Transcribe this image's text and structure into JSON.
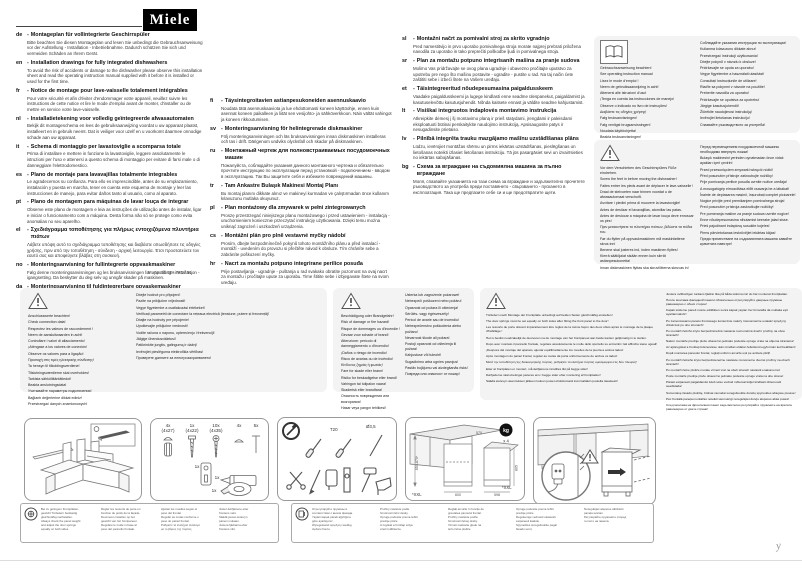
{
  "brand": {
    "logo": "Miele"
  },
  "doc_number": "M.-Nr. 10 006 780 / 01",
  "languages": {
    "col1": [
      {
        "code": "de",
        "title": "Montageplan für vollintegrierte Geschirrspüler",
        "body": "Bitte beachten Sie diesen Montageplan und lesen Sie unbedingt die Gebrauchsanweisung vor der Aufstellung - Installation - Inbetriebnahme. Dadurch schützen Sie sich und vermeiden Schäden an Ihrem Gerät."
      },
      {
        "code": "en",
        "title": "Installation drawings for fully integrated dishwashers",
        "body": "To avoid the risk of accidents or damage to the dishwasher please observe this installation sheet and read the operating instruction manual supplied with it before it is installed or used for the first time."
      },
      {
        "code": "fr",
        "title": "Notice de montage pour lave-vaisselle totalement intégrables",
        "body": "Pour votre sécurité et afin d'éviter d'endommager votre appareil, veuillez suivre les instructions de cette notice et lire le mode d'emploi avant de monter, d'installer ou de mettre en service votre lave-vaisselle."
      },
      {
        "code": "nl",
        "title": "Installatietekening voor volledig geïntegreerde afwasautomaten",
        "body": "Bekijk dit montageschema en lees de gebruiksaanwijzing voordat u uw apparaat plaatst, installeert en in gebruik neemt. Dat is veiliger voor uzelf en u voorkomt daarmee onnodige schade aan uw apparaat."
      },
      {
        "code": "it",
        "title": "Schema di montaggio per lavastoviglie a scomparsa totale",
        "body": "Prima di installare e mettere in funzione la lavastoviglie, leggere assolutamente le istruzioni per l'uso e attenersi a questo schema di montaggio per evitare di farsi male o di danneggiare l'elettrodomestico."
      },
      {
        "code": "es",
        "title": "Plano de montaje para lavavajillas totalmente integrables",
        "body": "Le agradecemos su confianza. Para ello es imprescindible, antes de su emplazamiento, instalación y puesta en marcha, tener en cuenta este esquema de montaje y leer las instrucciones de manejo, para evitar daños tanto al usuario, como al aparato."
      },
      {
        "code": "pt",
        "title": "Plano de montagem para máquinas de lavar louça de integrar",
        "body": "Observe este plano de montagem e leia as instruções de utilização antes de instalar, ligar e iniciar o funcionamento com a máquina. Desta forma não só se protege como evita anomalias no seu aparelho."
      },
      {
        "code": "el",
        "title": "Σχεδιάγραμμα τοποθέτησης για πλήρως εντοιχιζόμενα πλυντήρια πιάτων",
        "body": "Λάβετε υπόψη αυτό το σχεδιάγραμμα τοποθέτησης και διαβάστε οπωσδήποτε τις οδηγίες χρήσης, πριν από την τοποθέτηση - σύνδεση - αρχική λειτουργία. Έτσι προστατεύετε τον εαυτό σας και αποφεύγετε βλάβες στη συσκευή."
      },
      {
        "code": "no",
        "title": "Monteringsanvisning for fullintegrerte oppvaskmaskiner",
        "body": "Følg denne monteringsanvisningen og les bruksanvisningen før oppstilling - installasjon - igangsetting. Da beskytter du deg selv og unngår skader på maskinen."
      },
      {
        "code": "da",
        "title": "Monteringsanvisning til fuldintegrerbare opvaskemaskiner",
        "body": "Følg venligst denne monteringsplan, og læs brugsanvisningen inden opstilling, installation og ibrugtagning for at undgå skader på personer og produkt."
      }
    ],
    "col2": [
      {
        "code": "fi",
        "title": "Täysintegroitavien astianpesukoneiden asennuskaavio",
        "body": "Noudata tätä asennuskaaviota ja lue ehdottomasti koneen käyttöohje, ennen kuin asennat koneen paikalleen ja liität sen vesijohto- ja sähköverkkoon. Näin vältät vahingot ja koneen rikkoutumisen."
      },
      {
        "code": "sv",
        "title": "Monteringsanvisning för helintegrerade diskmaskiner",
        "body": "Följ monteringsanvisningen och läs bruksanvisningen innan diskmaskinen installeras och tas i drift. Därigenom undviks olycksfall och skador på diskmaskinen."
      },
      {
        "code": "ru",
        "title": "Монтажный чертеж для полновстраиваемых посудомоечных машин",
        "body": "Пожалуйста, соблюдайте указания данного монтажного чертежа и обязательно прочтите инструкцию по эксплуатации перед установкой - подключением - вводом в эксплуатацию. Так Вы защитите себя и избежите повреждений машины."
      },
      {
        "code": "tr",
        "title": "Tam Ankastre Bulaşık Makinesi Montaj Planı",
        "body": "Bu montaj planını dikkate alınız ve makineyi kurmadan ve çalıştırmadan önce kullanım kılavuzunu mutlaka okuyunuz."
      },
      {
        "code": "pl",
        "title": "Plan montażowy dla zmywarek w pełni zintegrowanych",
        "body": "Proszę przestrzegać niniejszego planu montażowego i przed ustawieniem - instalacją - uruchomieniem koniecznie przeczytać instrukcję użytkowania. Dzięki temu można uniknąć zagrożeń i uszkodzeń urządzenia."
      },
      {
        "code": "cs",
        "title": "Montážní plán pro plně vestavné myčky nádobí",
        "body": "Prosím, dbejte bezpodmínečně pokynů tohoto montážního plánu a před instalací - montáží - uvedením do provozu si přečtěte návod k obsluze. Tím chráníte sebe a zabráníte poškození myčky."
      },
      {
        "code": "hr",
        "title": "Nacrt za montažu potpuno integrirane perilice posuđa",
        "body": "Prije postavljanja - ugradnje - puštanja u rad svakako obratite pozornost na ovaj nacrt za montažu i pročitajte upute za uporabu. Time štitite sebe i izbjegavate štete na svom uređaju."
      }
    ],
    "col3": [
      {
        "code": "sl",
        "title": "Montažni načrt za pomivalni stroj za skrito vgradnjo",
        "body": "Pred namestitvijo in prvo uporabo pomivalnega stroja morate najprej prebrati priložena navodila za uporabo in tako preprečiti poškodbe ljudi in pomivalnega stroja."
      },
      {
        "code": "sr",
        "title": "Plan za montažu potpuno integrisanih mašina za pranje sudova",
        "body": "Molimo Vas pridržavajte se ovog plana ugradnje i obavezno pročitajte uputstvo za upotrebu pre nego što mašinu postavite - ugradite - pustite u rad. Na taj način ćete zaštititi sebe i izbeći štete na Vašem uređaju."
      },
      {
        "code": "et",
        "title": "Täisintegreeritud nõudepesumasina paigaldusskeem",
        "body": "Vaadake paigaldusskeemi ja lugege kindlasti enne seadme ülespanekut, paigaldamist ja kasutuselevõttu kasutusjuhendit. Nõnda kaitsete ennast ja väldite seadme kahjustamist."
      },
      {
        "code": "lt",
        "title": "Visiškai integruotos indaplovės montavimo instrukcija",
        "body": "Atkreipkite dėmesį į šį montavimo planą ir prieš statydami, įrengdami ir paleisdami eksploatuoti būtinai perskaitykite naudojimo instrukciją. Apsisaugosite patys ir nesugadinsite prietaiso."
      },
      {
        "code": "lv",
        "title": "Pilnībā integrēta trauku mazgājamo mašīnu uzstādīšanas plāns",
        "body": "Lūdzu, ievērojiet montāžas shēmu un pirms iekārtas uzstādīšanas, pieslēgšanas un lietošanas noteikti izlasiet lietošanas instrukciju. Tā jūs pasargāsiet sevi un izvairīsieties no iekārtas sabojāšanas."
      },
      {
        "code": "bg",
        "title": "Схема за вграждане на съдомиялна машина за пълно вграждане",
        "body": "Моля, спазвайте указанията на тази схема за вграждане и задължително прочетете ръководството за употреба преди поставянето - свързването - пускането в експлоатация. Така ще предпазите себе си и ще предотвратите щети."
      }
    ]
  },
  "manual_note": {
    "left": [
      "Gebrauchsanweisung beachten!",
      "See operating instruction manual",
      "Lisez le mode d'emploi !",
      "Neem de gebruiksaanwijzing in acht!",
      "Attenersi alle istruzioni d'uso!",
      "¡Tenga en cuenta las instrucciones de manejo!",
      "Observe o indicado no livro de instruções!",
      "Διαβάστε τις οδηγίες χρήσης!",
      "Følg bruksanvisningen!",
      "Følg venligst brugsanvisningen!",
      "Noudata käyttöohjetta!",
      "Beakta bruksanvisningen!"
    ],
    "right": [
      "Соблюдайте указания инструкции по эксплуатации!",
      "Kullanma kılavuzunu dikkate alınız!",
      "Przestrzegać instrukcji użytkowania!",
      "Dbejte pokynů v návodu k obsluze!",
      "Pridržavajte se uputa za uporabu!",
      "Vegye figyelembe a használati utasítást!",
      "Consultați Instrucțiunile de utilizare!",
      "Riaďte sa pokynmi v návode na použitie!",
      "Preberite navodila za uporabo!",
      "Pridržavajte se uputstva za upotrebu!",
      "Järgige kasutusjuhendit!",
      "Žiūrėkite naudojimosi instrukciją!",
      "Ievērojiet lietošanas instrukciju!",
      "Спазвайте ръководството за употреба!"
    ]
  },
  "feet_note": {
    "left": [
      "Vor dem Verschieben des Geschirrspülers Füße eindrehen.",
      "Screw the feet in before moving the dishwasher!",
      "Faites entrer les pieds avant de déplacer le lave-vaisselle !",
      "Draai de stelvoeten naar binnen voordat u de afwasautomaat verschuift.",
      "Avvitare i piedini prima di muovere la lavastoviglie!",
      "Antes de deslizar el lavavajillas, atornillar las patas.",
      "Antes de deslocar a máquina de lavar louça deve enroscar os pés!",
      "Πριν μετακινήσετε το πλυντήριο πιάτων, βιδώστε τα πόδια του.",
      "Før du flytter på oppvaskmaskinen må maskinføttene skrus inn!",
      "Benene skal justeres ind, inden maskinen flyttes!",
      "Kierrä säätöjalat sisään ennen kuin siirrät astianpesukonetta!",
      "Innan diskmaskinen flyttas ska skruvfötterna skruvas in!"
    ],
    "right": [
      "Перед перемещением посудомоечной машины необходимо ввернуть ножки!",
      "Bulaşık makinesini yerinden oynatmadan önce vidalı ayakları içeri çevirin!",
      "Przed przesunięciem zmywarki wkręcić nóżki!",
      "Před posunutím přístroje zašroubujte nožičky!",
      "Prije pomicanja perilice posuđa uvrnite nožice uređaja!",
      "A mosogatógép elmozdítása előtt csavarja be a lábakat!",
      "Înainte de deplasarea mașinii, înșurubați complet picioarele!",
      "Nogice privijte pred premikanjem pomivalnega stroja!",
      "Pred posunutím prístroja zaskrutkujte nožičky!",
      "Pre pomeranja mašine za pranje sudova uvrnite nogice!",
      "Enne nõudepesumasina nihutamist keerake jalad sisse.",
      "Prieš pajudinant indaplovę susukite kojeles!",
      "Pirms pārvietošanas ieskrūvējiet iekārtas kājas!",
      "Преди преместване на съдомиялната машина завийте крачетата навътре!"
    ]
  },
  "connection_note": {
    "left": [
      "Anschlusswerte beachten!",
      "Check connection data!",
      "Respectez les valeurs de raccordement !",
      "Neem de aansluitwaarden in acht!",
      "Controllare i valori di allacciamento!",
      "¡Aténgase a los valores de conexión!",
      "Observe os valores para a ligação!",
      "Προσοχή στις τιμές ηλεκτρικής σύνδεσης!",
      "Ta hensyn til tilkoblingsverdiene!",
      "Tilslutningsværdierne skal overholdes!",
      "Tarkista sähköliitäntätiedot!",
      "Beakta anslutningsdata!",
      "Учитывайте параметры подключения!",
      "Bağlantı değerlerine dikkat ediniz!",
      "Przestrzegać danych znamionowych!"
    ],
    "right": [
      "Dbejte hodnot pro připojení!",
      "Pazite na priključne vrijednosti!",
      "Vegye figyelembe a csatlakozási értékeket!",
      "Verificați parametrii de conectare la rețeaua electrică (tensiune, putere și frecvență)!",
      "Dbajte na hodnoty pre pripojenie!",
      "Upoštevajte priključne vrednosti!",
      "Vodite računa o naponu, opterećenju i frekvenciji!",
      "Jälgige ühendusväärtusi!",
      "Patikrinkite jungtis, galingumą ir dažnį!",
      "Ievērojiet pieslēguma elektrotīkla vērtības!",
      "Проверете данните за електрозахранването!"
    ]
  },
  "damage_note": {
    "left": [
      "Beschädigung oder Brandgefahr!",
      "Risk of damage or fire hazard!",
      "Risque de dommages ou d'incendie !",
      "Gevaar voor schade of brand!",
      "Attenzione: pericolo di danneggiamento o d'incendio!",
      "¡Daños o riesgo de incendio!",
      "Risco de avarias ou de incêndio!",
      "Κίνδυνος ζημιάς ή φωτιάς!",
      "Fare for skade eller brann!",
      "Risiko for beskadigelse eller brand!",
      "Vahingon tai tulipalon vaara!",
      "Skaderisk eller brandfara!",
      "Опасность повреждения или возгорания!",
      "Hasar veya yangın tehlikesi!"
    ],
    "right": [
      "Usterka lub zagrożenie pożarowe!",
      "Nebezpečí poškození nebo požáru!",
      "Opasnost od požara ili oštećenja!",
      "Sérülés- vagy égésveszély!",
      "Pericol de avarie sau de incendiu!",
      "Nebezpečenstvo poškodenia alebo požiaru!",
      "Nevarnost škode ali požara!",
      "Postoji opasnost od oštećenja ili požara!",
      "Kahjustuse või tuleoht!",
      "Sugadinimo arba ugnies pavojus!",
      "Pastāv bojājumu vai aizdegšanās risks!",
      "Повреда или опасност от пожар!"
    ]
  },
  "springs_note": {
    "left": [
      "Türfedern nach Montage der Frontplatte unbedingt auf beiden Seiten gleichmäßig einstellen!",
      "The door springs must be set equally on both sides after fitting the front panel to the door!",
      "Les ressorts de porte doivent impérativement être réglés de la même façon des deux côtés après le montage de la plaque d'habillage !",
      "Het is beslist noodzakelijk de deurveren na de montage van het frontpaneel aan beide kanten gelijkmatig in te stellen.",
      "Dopo aver montato il pannello frontale, regolare assolutamente le molle dello sportello su entrambi i lati affinché siano uguali!",
      "¡Después del montaje del aparato, ajustar equilibradamente los muelles de la puerta a ambos lados!",
      "Após montagem do painel frontal, regular as molas da porta uniformemente de ambos os lados!",
      "Μετά την τοποθέτηση της διακοσμητικής πόρτας, ρυθμίζετε τα ελατήρια πόρτας ομοιόμορφα στις δύο πλευρές!",
      "Etter at frontplaten er montert, må dørfjærene innstilles likt på begge sider!",
      "Dørfjederne skal ubetinget justeres ens i begge sider efter montering af frontpladen!",
      "Säädä etulevyn asennuksen jälkeen luukun jouset ehdottomasti kummaltakin puolelta tasaisesti!"
    ],
    "right": [
      "Justera ovillkorligen luckans fjädrar lika på båda sidorna när du har monterat frontplattan.",
      "После монтажа фасадной панели обязательно отрегулируйте дверные пружины равномерно с обеих сторон!",
      "Kapak süsleme paneli monte edildikten sonra kapak yayları her iki tarafta da mutlaka eşit ayarlanmalıdır!",
      "Po zamontowaniu panelu frontowego koniecznie należy równomiernie ustawić sprężyny drzwiczek po obu stronach!",
      "Po montáži čelního krytu bezpodmínečně nastavte rovnoměrně dveřní pružiny na obou stranách!",
      "Nakon montaže prednje ploče obavezno jednako podesite opruge vrata na objema stranama!",
      "Az ajtórugókat a frontlap felszerelése után mindkét oldalon feltétlenül egyformán kell beállítani!",
      "După montarea panoului frontal, reglați uniform arcurile ușii pe ambele părți!",
      "Po montáži čelného krytu bezpodmienečne nastavte rovnomerne dverné pružiny na oboch stranách!",
      "Po montaži čelne plošče morate vzmeti vrat na obeh straneh nastaviti enakomerno!",
      "Posle montaže prednje ploče obavezno jednako podesite opruge vrata na obe strane!",
      "Pärast esipaneeli paigaldamist tuleb ukse vedrud mõlemal küljel kindlasti ühtemoodi seadistada!",
      "Sumontavę fasado plokštę, būtinai vienodai sureguliuokite durelių spyruokles abiejose pusėse!",
      "Pēc frontālā paneļa montāžas noteikti vienmērīgi noregulējiet durvju atsperes abās pusēs!",
      "След монтажа на фронталния панел задължително регулирайте пружините на вратата равномерно от двете страни!"
    ]
  },
  "parts": {
    "top": [
      {
        "qty": "4x",
        "size": "(4x27)"
      },
      {
        "qty": "1x",
        "size": "(4x22)"
      },
      {
        "qty": "10x",
        "size": "(4x35)"
      },
      {
        "qty": "4x",
        "size": ""
      },
      {
        "qty": "5x",
        "size": ""
      }
    ],
    "bottom": [
      "1x",
      "1x",
      "1x"
    ]
  },
  "tools": {
    "label_torx": "T20",
    "label_drill": "Ø3,5"
  },
  "niche": {
    "badge": "kg",
    "multiplier": "x 4",
    "footnote_left": "*XXL",
    "footnote_right": "*XXL",
    "dims": {
      "height_range": "850-870*",
      "width": "600",
      "depth": "570",
      "app_width": "598",
      "app_height": "805"
    }
  },
  "fine_print": {
    "box1": [
      [
        "Bei zu geringem Frontplatten-",
        "gewicht Türfedern beidseitig",
        "gleichmäßig nachstellen.",
        "Always check the panel weight",
        "and adjust the door springs",
        "equally on both sides."
      ],
      [
        "Régler les ressorts de porte en",
        "fonction du poids de la façade.",
        "Deurveren instellen op het",
        "gewicht van het frontpaneel.",
        "Regolare le molle in base al",
        "peso del pannello frontale."
      ],
      [
        "Ajustar los muelles según el",
        "peso del frontal.",
        "Regular as molas conforme o",
        "peso do painel frontal.",
        "Ρυθμίστε τα ελατήρια ανάλογα",
        "με το βάρος της πόρτας."
      ],
      [
        "Juster dørfjærene etter",
        "frontens vekt.",
        "Säädä jouset etulevyn",
        "painon mukaan.",
        "Justera fjädrarna efter",
        "frontens vikt."
      ]
    ],
    "box2": [
      [
        "Отрегулируйте пружины в",
        "соответствии с весом фасада.",
        "Yayları kapak paneli ağırlığına",
        "göre ayarlayınız.",
        "Wyregulować sprężyny według",
        "ciężaru frontu."
      ],
      [
        "Pružiny nastavte podle",
        "hmotnosti čelní desky.",
        "Opruge podesite prema težini",
        "prednje ploče.",
        "A rugókat a frontlap súlya",
        "szerint állítsa be."
      ],
      [
        "Reglați arcurile în funcție de",
        "greutatea panoului frontal.",
        "Pružiny nastavte podľa",
        "hmotnosti čelnej dosky.",
        "Vzmeti nastavite glede na",
        "težo čelne plošče."
      ],
      [
        "Opruge podesite prema težini",
        "prednje ploče.",
        "Reguleerige vedrusid vastavalt",
        "esipaneeli kaalule.",
        "Spyruokles sureguliuokite pagal",
        "fasado svorį."
      ],
      [
        "Noregulējiet atsperes atbilstoši",
        "paneļa svaram.",
        "Регулирайте пружините според",
        "теглото на панела."
      ]
    ]
  },
  "marks": {
    "corner": "y"
  }
}
